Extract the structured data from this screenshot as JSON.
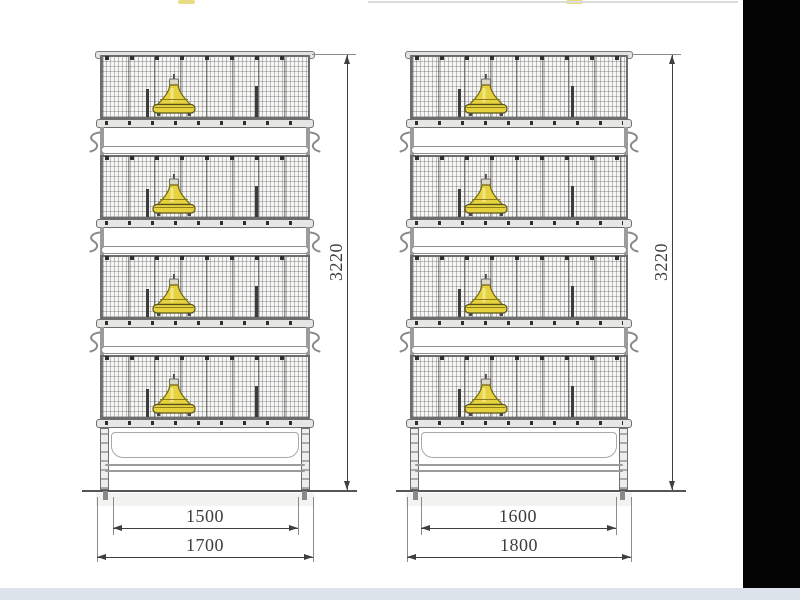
{
  "colors": {
    "dim_line": "#3f3f3f",
    "frame_line": "#6d6d6d",
    "mesh_fill": "#f6f6f5",
    "feeder_yellow": "#e6d23e",
    "feeder_rim": "#6f6410",
    "letterbox": "#040404",
    "bottom_band": "#dde3ea"
  },
  "cages": [
    {
      "label": "left-four-tier-cage",
      "tiers": 4,
      "height_label": "3220",
      "inner_width_label": "1500",
      "outer_width_label": "1700"
    },
    {
      "label": "right-four-tier-cage",
      "tiers": 4,
      "height_label": "3220",
      "inner_width_label": "1600",
      "outer_width_label": "1800"
    }
  ]
}
